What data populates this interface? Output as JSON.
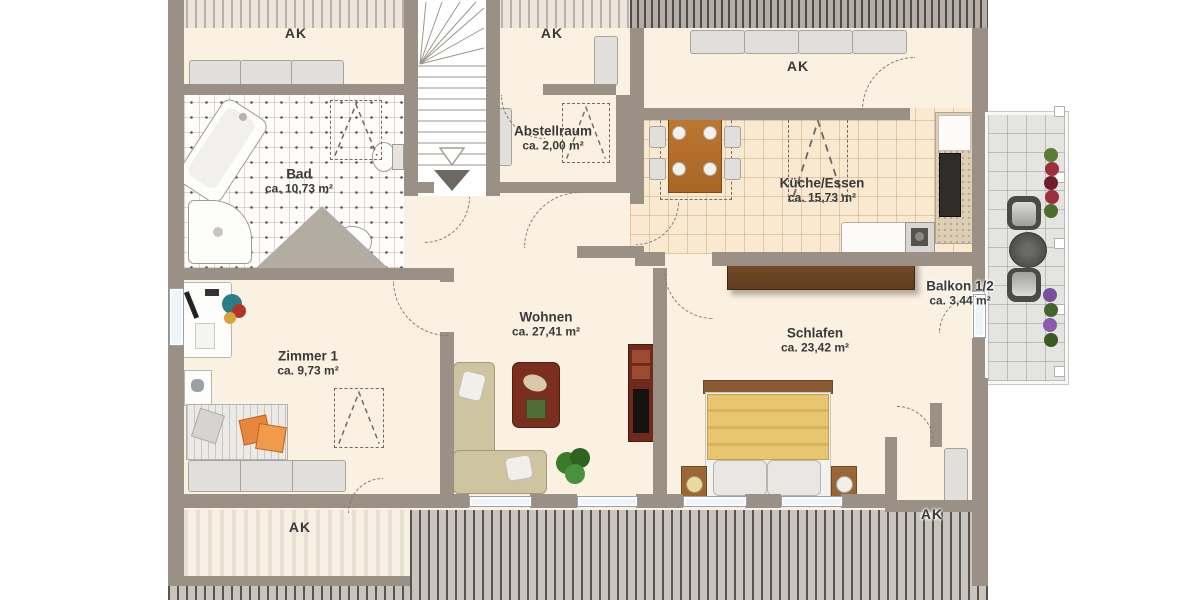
{
  "plan": {
    "rooms": {
      "bad": {
        "name": "Bad",
        "area": "ca. 10,73 m²"
      },
      "abstellraum": {
        "name": "Abstellraum",
        "area": "ca. 2,00 m²"
      },
      "kueche_essen": {
        "name": "Küche/Essen",
        "area": "ca. 15,73 m²"
      },
      "balkon": {
        "name": "Balkon 1/2",
        "area": "ca. 3,44 m²"
      },
      "wohnen": {
        "name": "Wohnen",
        "area": "ca. 27,41 m²"
      },
      "schlafen": {
        "name": "Schlafen",
        "area": "ca. 23,42 m²"
      },
      "zimmer1": {
        "name": "Zimmer 1",
        "area": "ca. 9,73 m²"
      }
    },
    "ak_labels": {
      "top_left": "AK",
      "top_middle": "AK",
      "kitchen": "AK",
      "bottom_left": "AK",
      "bottom_right": "AK"
    },
    "colors": {
      "wall": "#9b9086",
      "floor_cream": "#fbf1e2",
      "kitchen_floor": "#f9e9d1",
      "balcony_gray": "#e4e4e2",
      "wood": "#b5702c",
      "dark_wood": "#6b4423",
      "accent_red": "#7c2e1e",
      "blanket_yellow": "#e7c66f",
      "sofa_beige": "#cec49f"
    }
  }
}
